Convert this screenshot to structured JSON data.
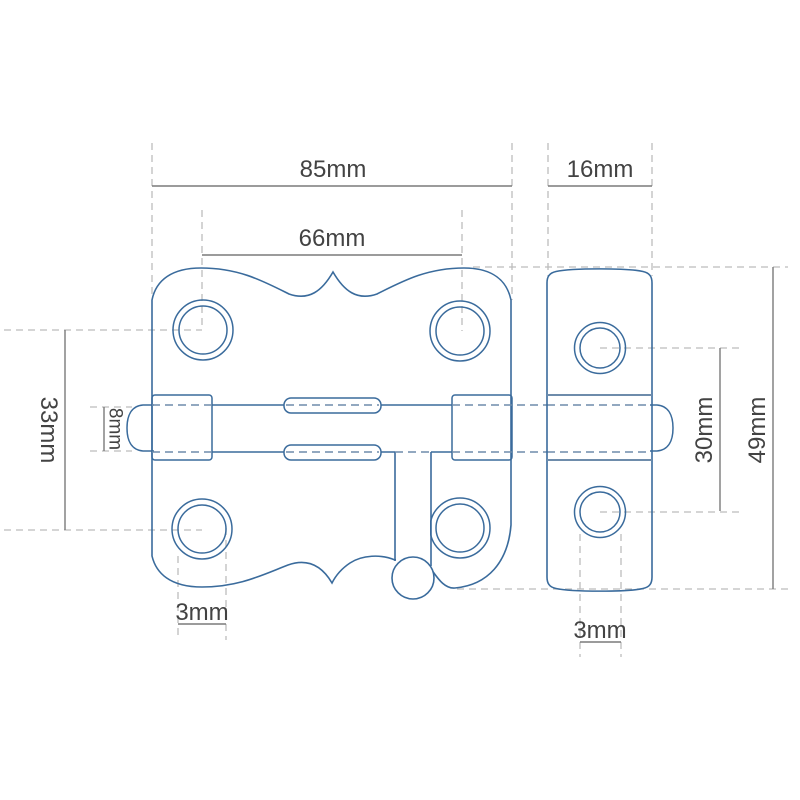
{
  "drawing_title": "Barrel bolt latch technical drawing, front view with dimensions",
  "colors": {
    "part_line_blue": "#3a6b9c",
    "hidden_line_blue": "#6e8cab",
    "dimension_line_gray": "#7a7a7a",
    "extension_line_gray": "#bcbcbc",
    "label_text_gray": "#434343",
    "background": "#ffffff"
  },
  "dimensions": {
    "overall_plate_width": "85mm",
    "keeper_plate_width": "16mm",
    "hole_spacing_horizontal": "66mm",
    "hole_spacing_vertical": "33mm",
    "bolt_rod_diameter": "8mm",
    "keeper_hole_spacing": "30mm",
    "keeper_plate_height": "49mm",
    "plate_hole_offset": "3mm",
    "keeper_hole_offset": "3mm"
  }
}
